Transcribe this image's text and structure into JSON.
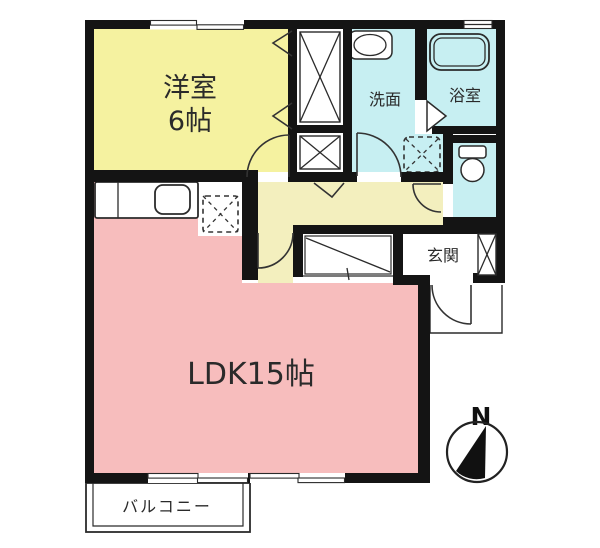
{
  "rooms": {
    "western": {
      "label": "洋室",
      "size": "6帖",
      "color": "#F5F2A0"
    },
    "ldk": {
      "label": "LDK15帖",
      "color": "#F7BDBD"
    },
    "washroom": {
      "label": "洗面",
      "color": "#C7EFF2"
    },
    "bathroom": {
      "label": "浴室",
      "color": "#C7EFF2"
    },
    "toilet": {
      "color": "#C7EFF2"
    },
    "hallway": {
      "color": "#F3EFBE"
    },
    "entrance": {
      "label": "玄関"
    },
    "balcony": {
      "label": "バルコニー"
    }
  },
  "compass": {
    "label": "N"
  },
  "palette": {
    "wall": "#141414",
    "fixture_outline": "#2b2b2b",
    "text": "#2a2a2a",
    "background": "#ffffff"
  }
}
